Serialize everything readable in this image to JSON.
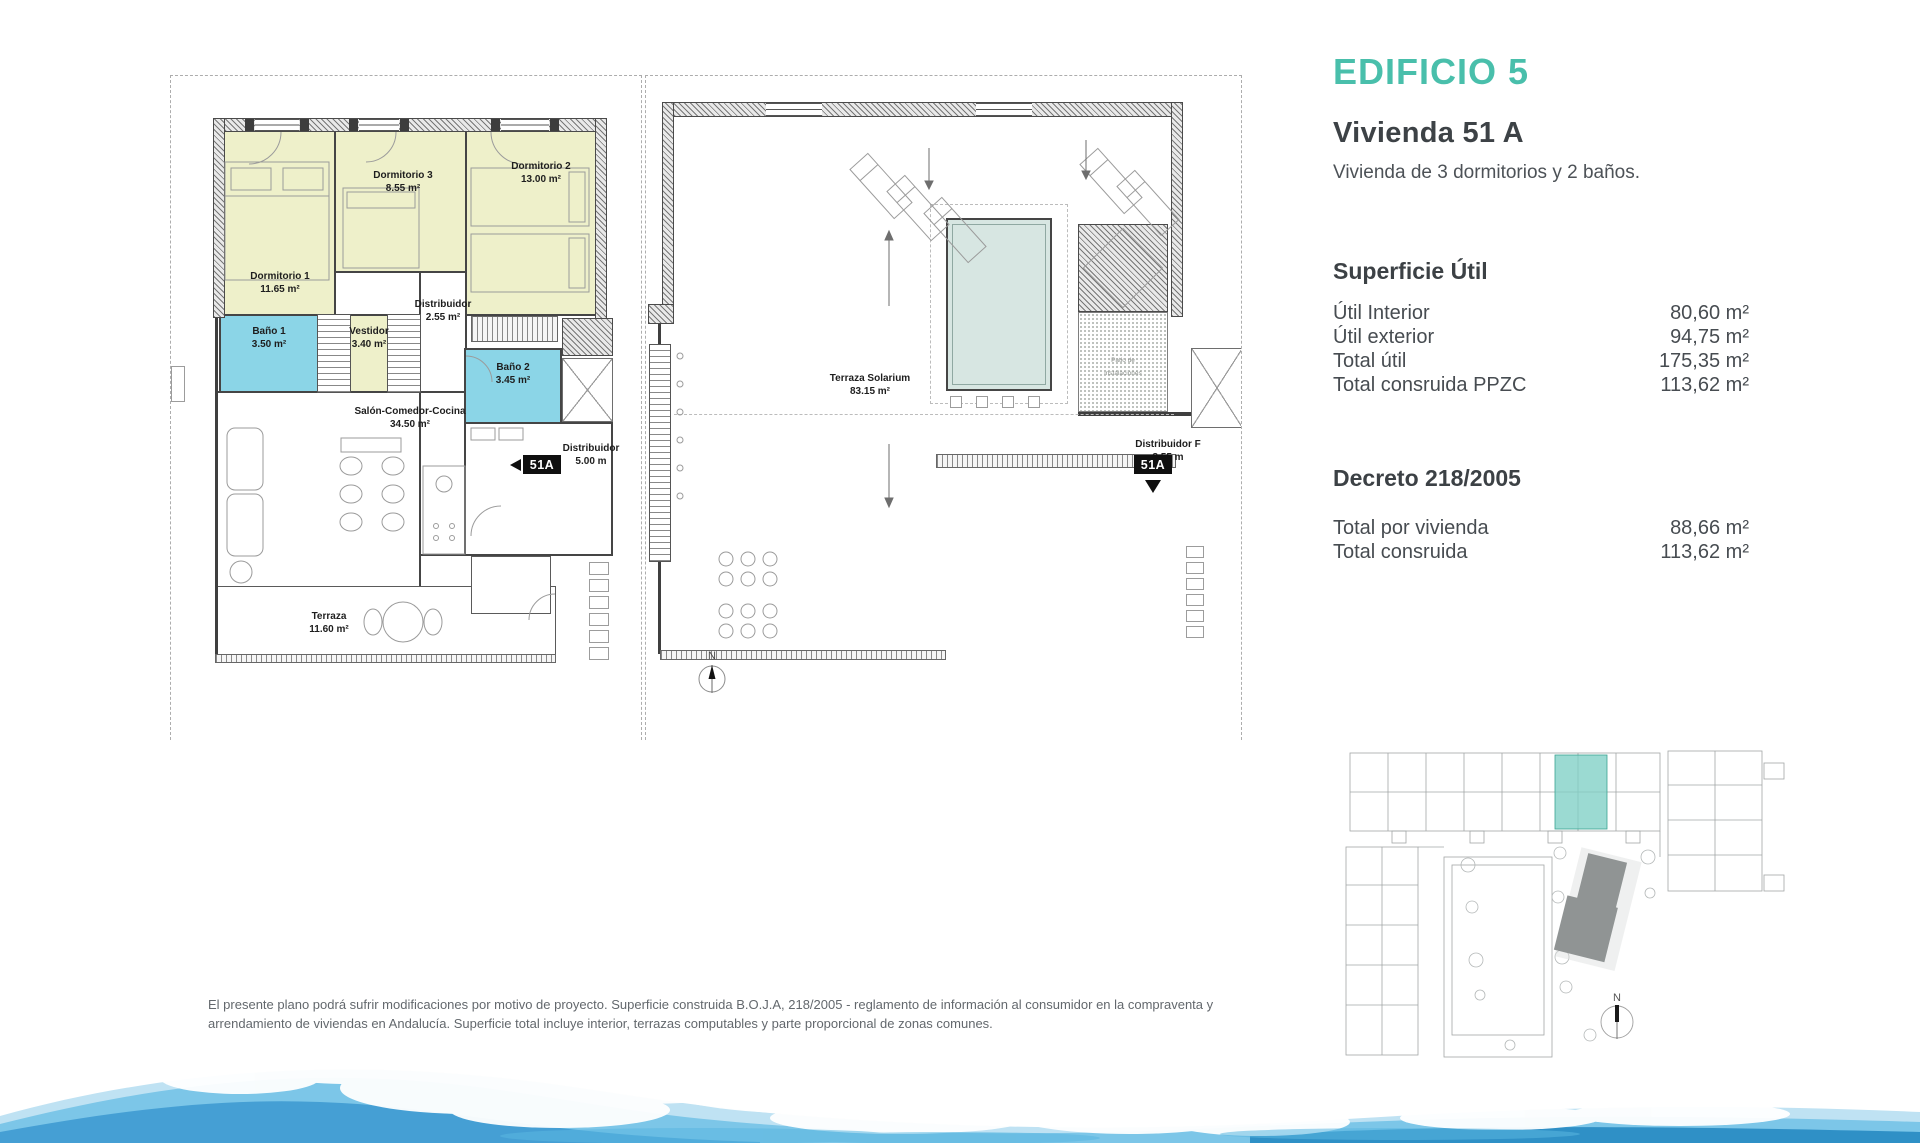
{
  "header": {
    "building_title": "EDIFICIO 5",
    "unit_title": "Vivienda 51 A",
    "unit_subtitle": "Vivienda de 3 dormitorios y 2 baños."
  },
  "superficie": {
    "heading": "Superficie Útil",
    "rows": [
      {
        "label": "Útil Interior",
        "value": "80,60 m²"
      },
      {
        "label": "Útil exterior",
        "value": "94,75 m²"
      },
      {
        "label": "Total útil",
        "value": "175,35 m²"
      },
      {
        "label": "Total consruida PPZC",
        "value": "113,62 m²"
      }
    ]
  },
  "decreto": {
    "heading": "Decreto 218/2005",
    "rows": [
      {
        "label": "Total por vivienda",
        "value": "88,66 m²"
      },
      {
        "label": "Total consruida",
        "value": "113,62 m²"
      }
    ]
  },
  "plan_apartment": {
    "rooms": {
      "dorm1": {
        "name": "Dormitorio 1",
        "area": "11.65 m²"
      },
      "dorm3": {
        "name": "Dormitorio 3",
        "area": "8.55 m²"
      },
      "dorm2": {
        "name": "Dormitorio 2",
        "area": "13.00 m²"
      },
      "bano1": {
        "name": "Baño 1",
        "area": "3.50 m²"
      },
      "vestidor": {
        "name": "Vestidor",
        "area": "3.40 m²"
      },
      "distribuidor": {
        "name": "Distribuidor",
        "area": "2.55 m²"
      },
      "bano2": {
        "name": "Baño 2",
        "area": "3.45 m²"
      },
      "salon": {
        "name": "Salón-Comedor-Cocina",
        "area": "34.50 m²"
      },
      "terraza": {
        "name": "Terraza",
        "area": "11.60 m²"
      },
      "hall": {
        "name": "Distribuidor",
        "area": "5.00 m"
      }
    },
    "unit_badge": "51A"
  },
  "plan_roof": {
    "labels": {
      "solarium": {
        "name": "Terraza Solarium",
        "area": "83.15 m²"
      },
      "patio": {
        "name": "Patio de",
        "name2": "instalaciones"
      },
      "hall": {
        "name": "Distribuidor F",
        "area": "8.55 m"
      }
    },
    "unit_badge": "51A"
  },
  "compass_label": "N",
  "disclaimer": {
    "line1": "El presente plano podrá sufrir modificaciones por motivo de proyecto. Superficie construida B.O.J.A, 218/2005 - reglamento de información al consumidor en la compraventa y",
    "line2": "arrendamiento de viviendas en Andalucía. Superficie total incluye interior, terrazas computables y parte proporcional de zonas comunes."
  },
  "colors": {
    "accent_teal": "#49bfab",
    "room_yellow": "#eef0ca",
    "room_cyan": "#8bd5e7",
    "pool_blue": "#d7e6e2",
    "site_highlight": "#7fd0c5",
    "wave_blue": "#459fd4"
  }
}
